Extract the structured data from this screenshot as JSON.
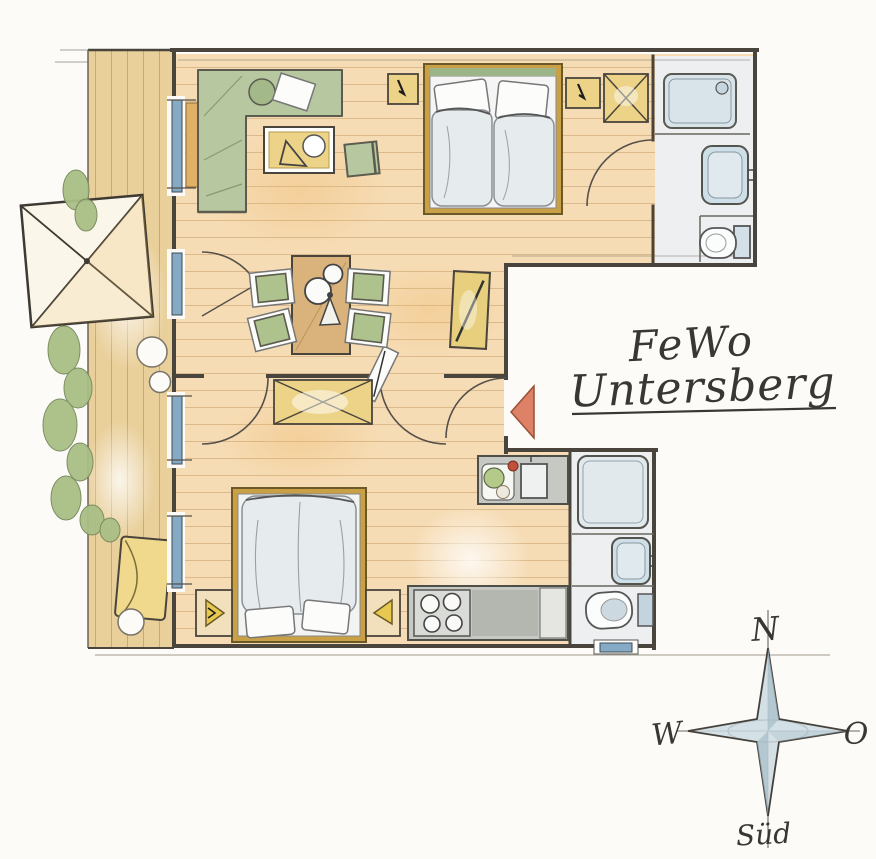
{
  "title": {
    "line1": "FeWo",
    "line2": "Untersberg"
  },
  "compass": {
    "north": "N",
    "west": "W",
    "east": "O",
    "south": "Süd"
  },
  "palette": {
    "paper": "#fcfbf8",
    "ink": "#4a453c",
    "hand_ink": "#3a3732",
    "wood_floor": "#f6dcb5",
    "terrace_deck": "#e9cf9a",
    "plank_line": "#b98e56",
    "sofa_green": "#b7c8a0",
    "chair_green": "#aec28d",
    "bed_frame": "#c9a045",
    "duvet": "#e6ebee",
    "linen_white": "#fcfcfa",
    "furniture_yellow": "#ecd387",
    "bath_floor": "#edeff0",
    "fixture_blue": "#cfdfe8",
    "window_blue": "#85aac6",
    "counter_gray": "#c6c8c3",
    "stove_gray": "#d9dbd7",
    "entrance_arrow": "#dd8266",
    "compass_blue": "#cbdae2",
    "plant_green": "#a9bf86",
    "lounger_yellow": "#f0d98c"
  }
}
